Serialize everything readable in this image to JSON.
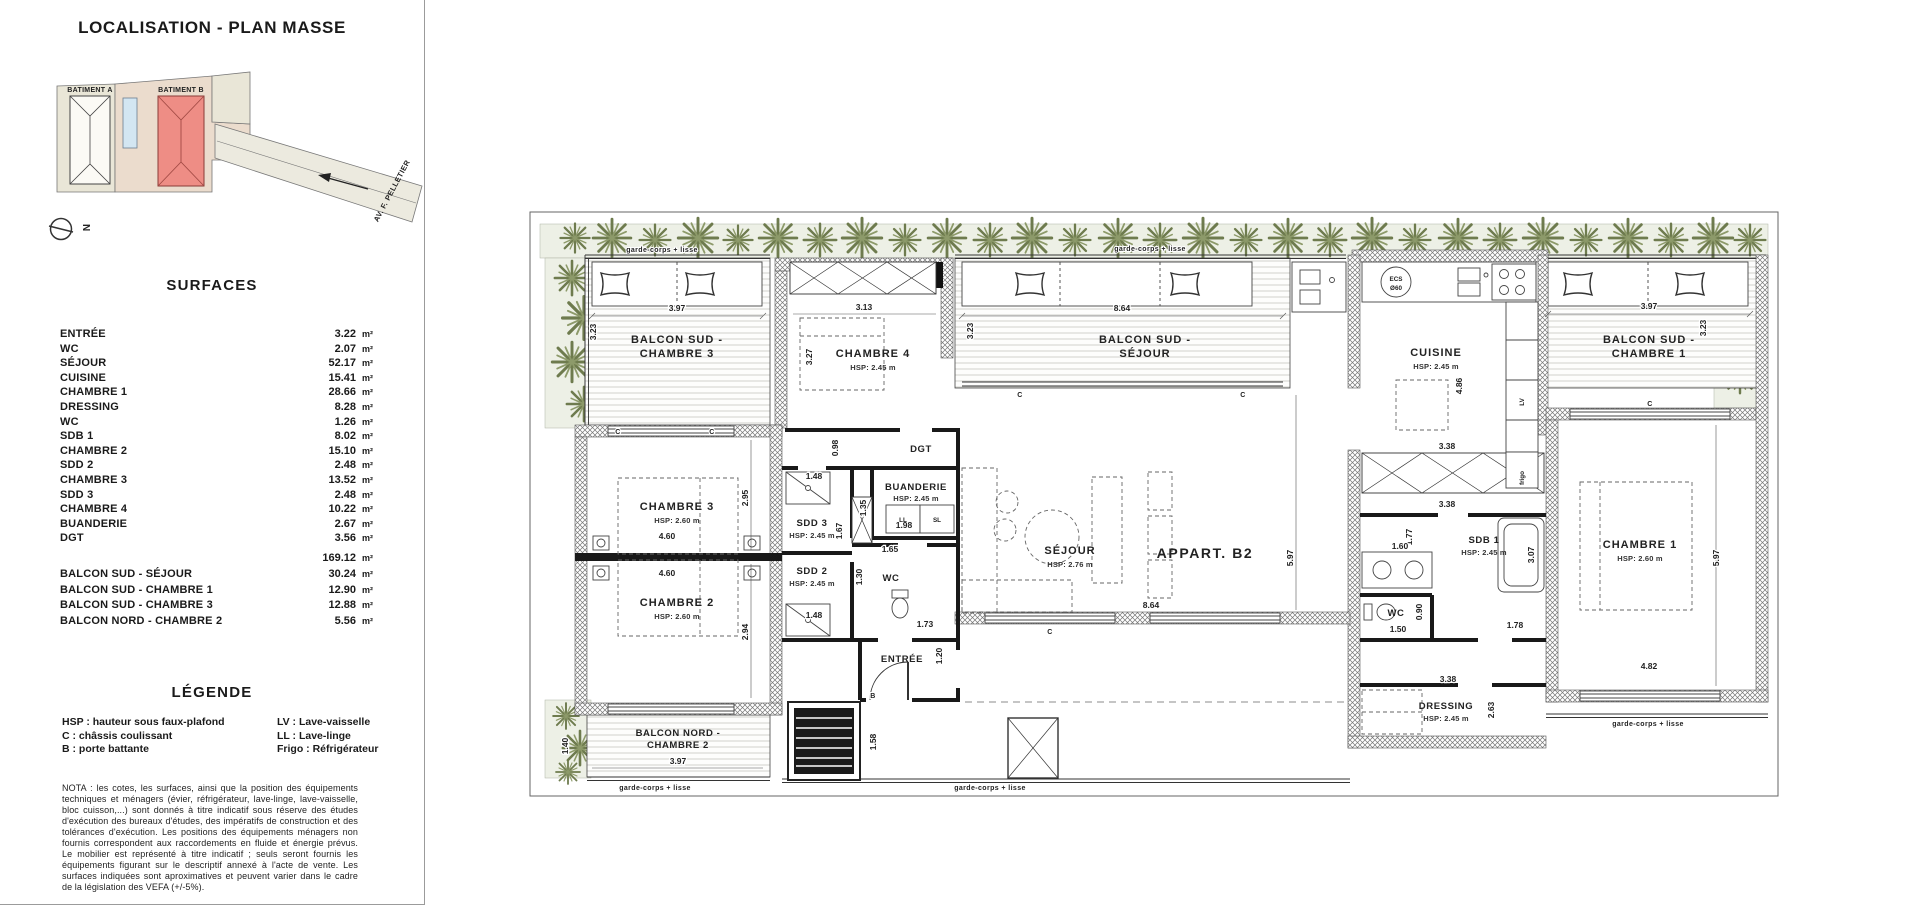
{
  "sidebar": {
    "title": "LOCALISATION - PLAN MASSE",
    "site": {
      "building_a": "BATIMENT A",
      "building_b": "BATIMENT B",
      "street": "AV. F. PELLETIER",
      "north": "N"
    },
    "surfaces": {
      "title": "SURFACES",
      "unit": "m²",
      "rows": [
        {
          "label": "ENTRÉE",
          "value": "3.22"
        },
        {
          "label": "WC",
          "value": "2.07"
        },
        {
          "label": "SÉJOUR",
          "value": "52.17"
        },
        {
          "label": "CUISINE",
          "value": "15.41"
        },
        {
          "label": "CHAMBRE 1",
          "value": "28.66"
        },
        {
          "label": "DRESSING",
          "value": "8.28"
        },
        {
          "label": "WC",
          "value": "1.26"
        },
        {
          "label": "SDB 1",
          "value": "8.02"
        },
        {
          "label": "CHAMBRE 2",
          "value": "15.10"
        },
        {
          "label": "SDD 2",
          "value": "2.48"
        },
        {
          "label": "CHAMBRE 3",
          "value": "13.52"
        },
        {
          "label": "SDD 3",
          "value": "2.48"
        },
        {
          "label": "CHAMBRE 4",
          "value": "10.22"
        },
        {
          "label": "BUANDERIE",
          "value": "2.67"
        },
        {
          "label": "DGT",
          "value": "3.56"
        }
      ],
      "total": "169.12",
      "balconies": [
        {
          "label": "BALCON SUD - SÉJOUR",
          "value": "30.24"
        },
        {
          "label": "BALCON SUD - CHAMBRE 1",
          "value": "12.90"
        },
        {
          "label": "BALCON SUD - CHAMBRE 3",
          "value": "12.88"
        },
        {
          "label": "BALCON NORD - CHAMBRE 2",
          "value": "5.56"
        }
      ]
    },
    "legend": {
      "title": "LÉGENDE",
      "left": [
        "HSP : hauteur sous faux-plafond",
        "C : châssis coulissant",
        "B : porte battante"
      ],
      "right": [
        "LV : Lave-vaisselle",
        "LL : Lave-linge",
        "Frigo : Réfrigérateur"
      ]
    },
    "nota": "NOTA : les cotes, les surfaces, ainsi que la position des équipements techniques et ménagers (évier, réfrigérateur, lave-linge, lave-vaisselle, bloc cuisson,...) sont donnés à titre indicatif sous réserve des études d'exécution des bureaux d'études, des impératifs de construction et des tolérances d'exécution. Les positions des équipements ménagers non fournis correspondent aux raccordements en fluide et énergie prévus. Le mobilier est représenté à titre indicatif ; seuls seront fournis les équipements figurant sur le descriptif annexé à l'acte de vente. Les surfaces indiquées sont aproximatives et peuvent varier dans le cadre de la législation des VEFA (+/-5%)."
  },
  "plan": {
    "apartment": "APPART. B2",
    "garde_corps": "garde-corps + lisse",
    "rooms": {
      "balc_s_ch3": [
        "BALCON SUD -",
        "CHAMBRE 3"
      ],
      "balc_s_sejour": [
        "BALCON SUD -",
        "SÉJOUR"
      ],
      "balc_s_ch1": [
        "BALCON SUD -",
        "CHAMBRE 1"
      ],
      "balc_n_ch2": [
        "BALCON NORD -",
        "CHAMBRE 2"
      ],
      "ch4": "CHAMBRE 4",
      "cuisine": "CUISINE",
      "dgt": "DGT",
      "buanderie": "BUANDERIE",
      "sdd3": "SDD 3",
      "sdd2": "SDD 2",
      "wc": "WC",
      "ch3": "CHAMBRE 3",
      "ch2": "CHAMBRE 2",
      "sejour": "SÉJOUR",
      "sdb1": "SDB 1",
      "ch1": "CHAMBRE 1",
      "dressing": "DRESSING",
      "entree": "ENTRÉE"
    },
    "hsp": {
      "h245": "HSP: 2.45 m",
      "h260": "HSP: 2.60 m",
      "h276": "HSP: 2.76 m"
    },
    "dims": {
      "v397": "3.97",
      "v323": "3.23",
      "v313": "3.13",
      "v327": "3.27",
      "v864": "8.64",
      "v486": "4.86",
      "v098": "0.98",
      "v148": "1.48",
      "v460": "4.60",
      "v295": "2.95",
      "v294": "2.94",
      "v135": "1.35",
      "v198": "1.98",
      "v165": "1.65",
      "v130": "1.30",
      "v167": "1.67",
      "v173": "1.73",
      "v120": "1.20",
      "v158": "1.58",
      "v140": "1.40",
      "v597": "5.97",
      "v338": "3.38",
      "v177": "1.77",
      "v160": "1.60",
      "v307": "3.07",
      "v178": "1.78",
      "v150": "1.50",
      "v090": "0.90",
      "v263": "2.63",
      "v482": "4.82"
    },
    "marks": {
      "c": "C",
      "b": "B",
      "ll": "LL",
      "sl": "SL",
      "lv": "LV",
      "frigo": "frigo",
      "ecs1": "ECS",
      "ecs2": "Ø60"
    }
  }
}
